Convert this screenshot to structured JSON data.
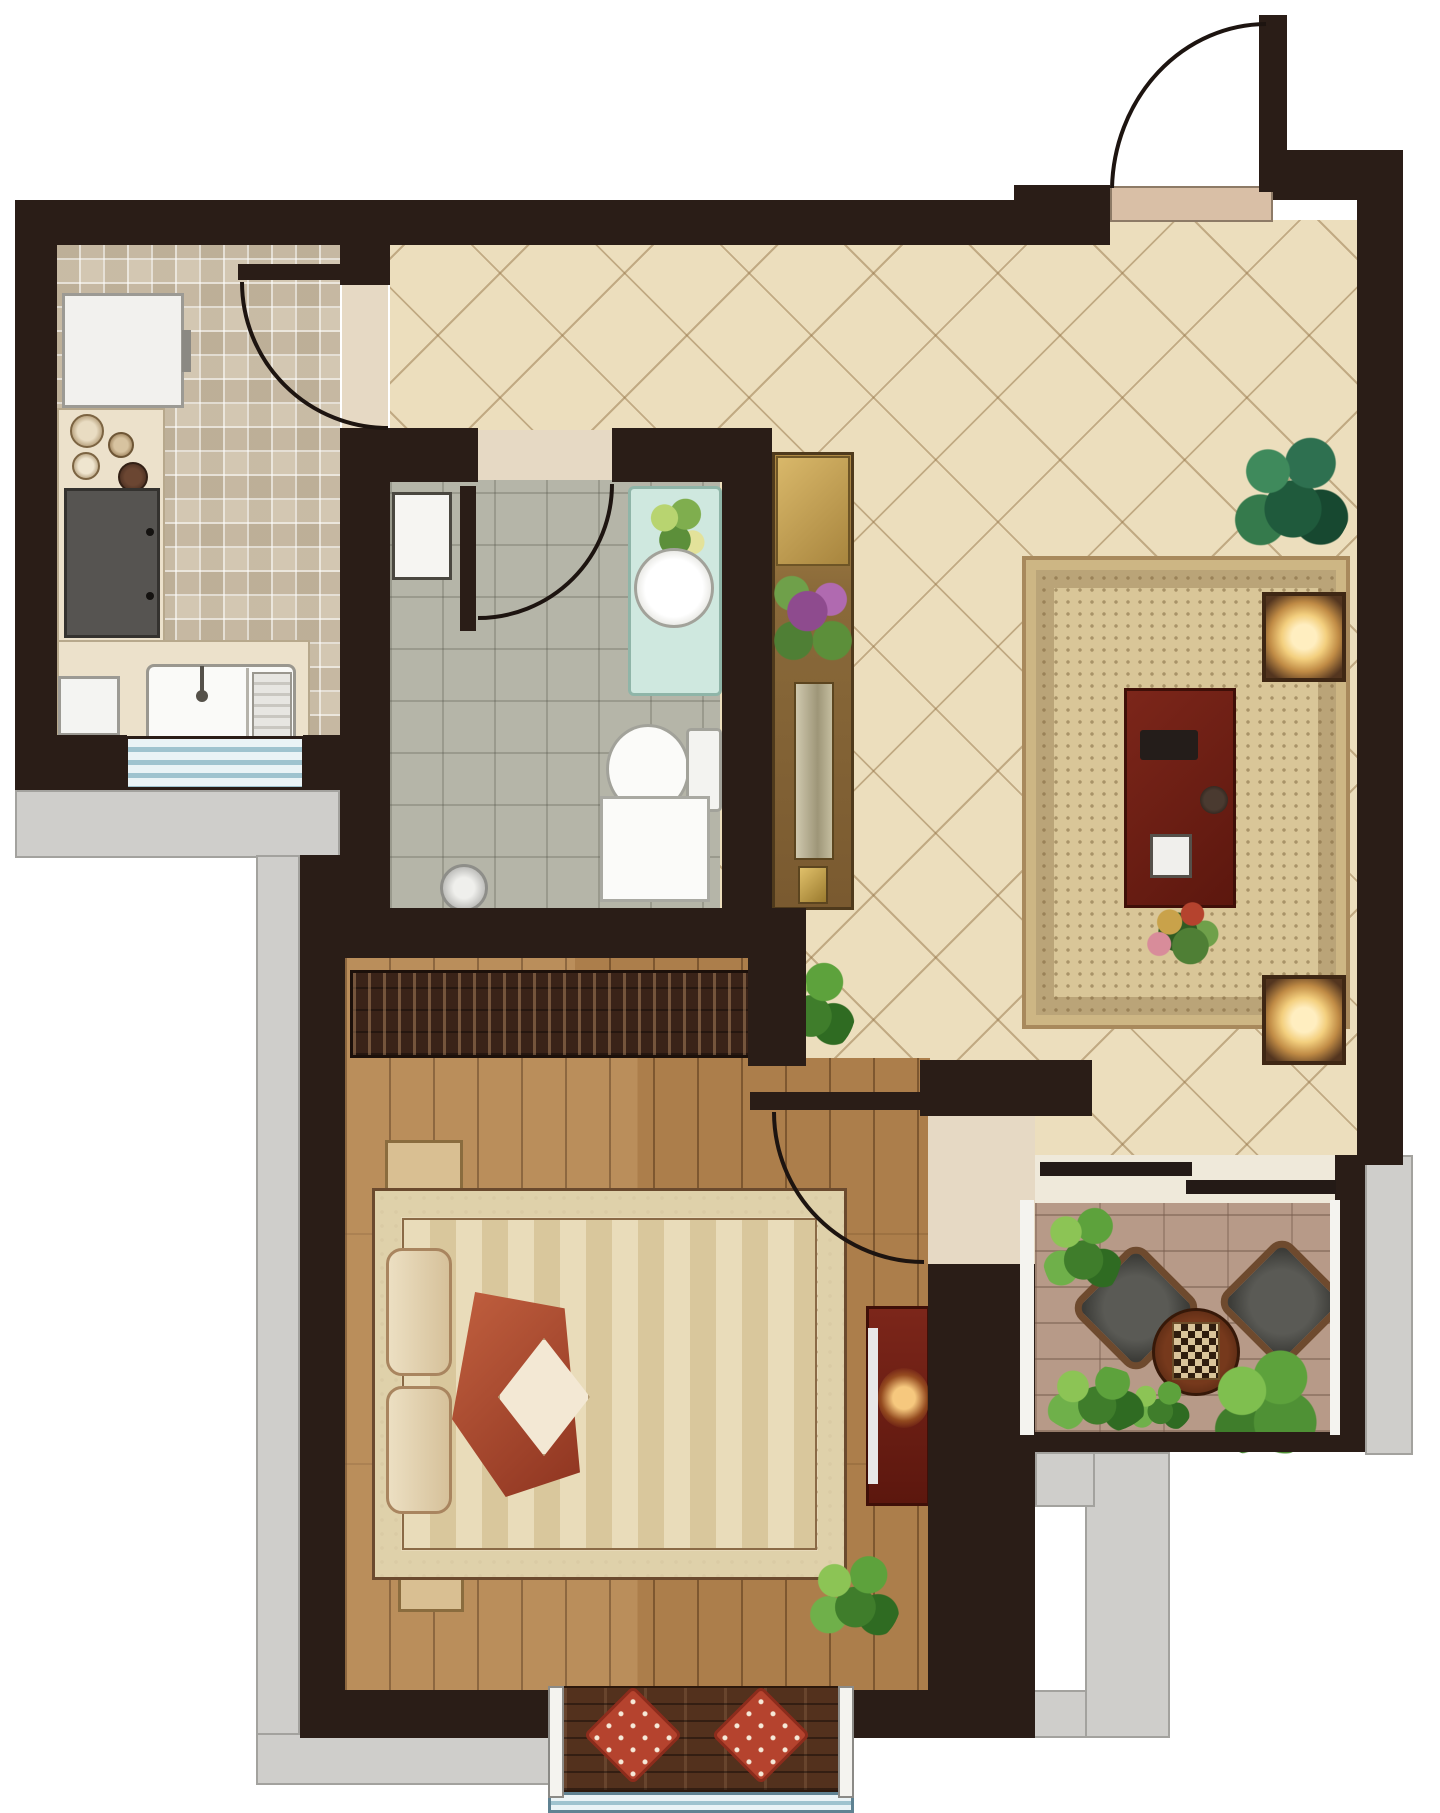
{
  "meta": {
    "description": "Rendered top-down interior floor plan of a one-bedroom apartment; decorative color illustration with no visible text labels or dimensions",
    "type": "floor-plan"
  },
  "rooms": {
    "entrance": {
      "label": "Entrance",
      "features": [
        "entry door with outward swing arc",
        "beige threshold"
      ]
    },
    "kitchen": {
      "label": "Kitchen",
      "floor": "beige mosaic tile",
      "features": [
        "refrigerator",
        "spice jars",
        "gas stove with two burners",
        "L-shaped counter",
        "double sink with faucet",
        "striped window on bottom wall",
        "door swinging into kitchen"
      ]
    },
    "hallway": {
      "label": "Hallway / Foyer",
      "floor": "cream diagonal tile"
    },
    "living_room": {
      "label": "Living Room",
      "floor": "cream diagonal tile",
      "features": [
        "loveseat",
        "three-seat sofa",
        "armchair",
        "two lamp side tables",
        "dark red coffee table",
        "flower centerpiece",
        "patterned area rug",
        "ornate console cabinet with flowers",
        "potted plants",
        "sliding door to balcony"
      ]
    },
    "bathroom": {
      "label": "Bathroom",
      "floor": "gray tile",
      "features": [
        "washbasin on aqua counter",
        "toilet with tank",
        "hand shower",
        "shower tray",
        "wall panel window",
        "door swinging inward"
      ]
    },
    "bedroom": {
      "label": "Bedroom",
      "floor": "wood plank",
      "features": [
        "full-width wardrobe",
        "double bed with ornate border, striped duvet, pillows, red throw",
        "two nightstands with clocks",
        "dark red TV cabinet with glowing screen",
        "potted plant",
        "bay window bench with two red polka-dot cushions"
      ]
    },
    "balcony": {
      "label": "Balcony",
      "floor": "brick pavers",
      "features": [
        "two wicker lounge chairs",
        "round tea table with checkerboard",
        "green plants"
      ]
    }
  },
  "palette": {
    "wall": "#2a1d17",
    "tile_cream": "#ecdebd",
    "tile_kitchen": "#d3c7b2",
    "tile_bath": "#b5b5a8",
    "wood": "#b5854f",
    "brick": "#b79a88",
    "ledge": "#cfcecb",
    "threshold": "#d9bfa6",
    "window_blue": "#9fc3cf",
    "accent_red": "#b5432e",
    "coffee_table_red": "#6e1f16",
    "lamp_glow": "#ffeec0"
  }
}
